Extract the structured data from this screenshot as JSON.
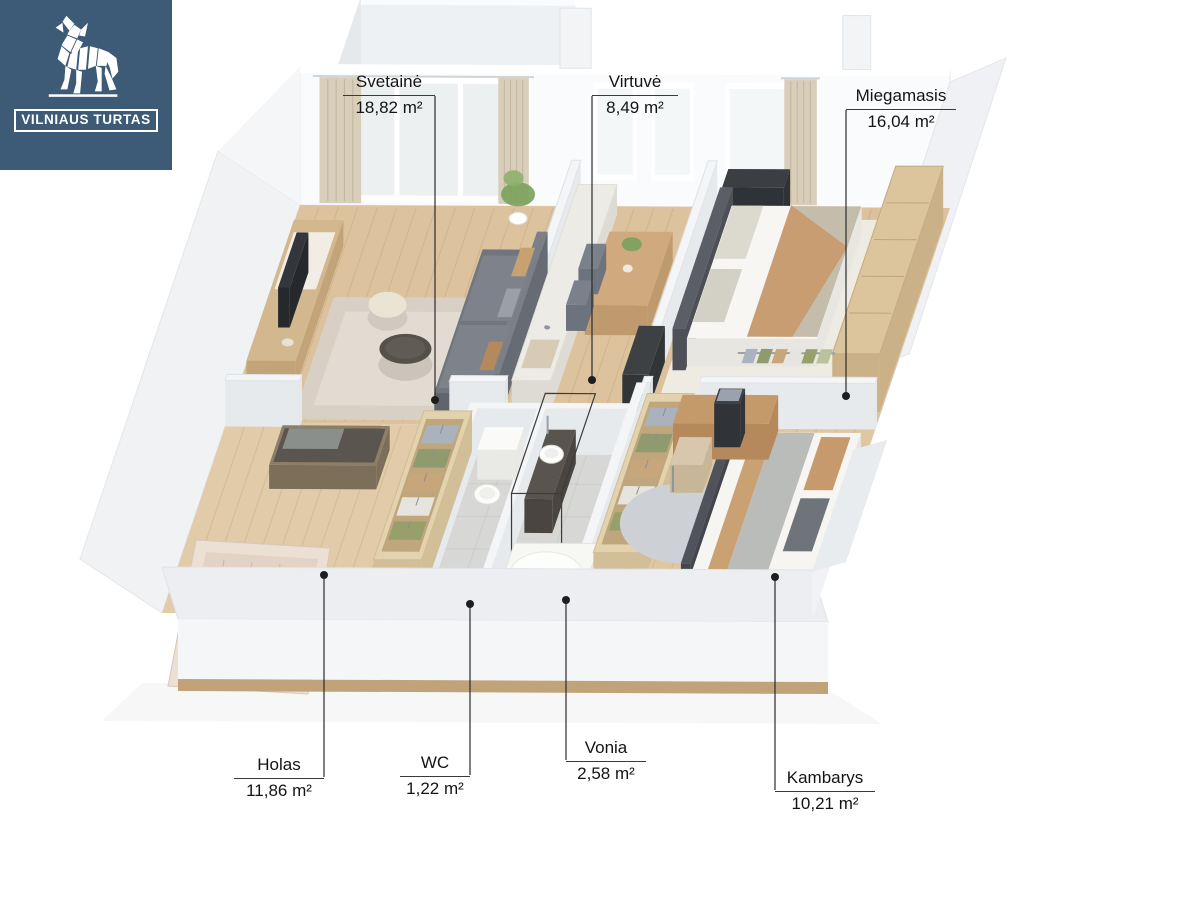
{
  "logo": {
    "company": "VILNIAUS TURTAS"
  },
  "rooms": [
    {
      "id": "svetaine",
      "name": "Svetainė",
      "area": "18,82 m²"
    },
    {
      "id": "virtuve",
      "name": "Virtuvė",
      "area": "8,49 m²"
    },
    {
      "id": "miegamasis",
      "name": "Miegamasis",
      "area": "16,04 m²"
    },
    {
      "id": "holas",
      "name": "Holas",
      "area": "11,86 m²"
    },
    {
      "id": "wc",
      "name": "WC",
      "area": "1,22 m²"
    },
    {
      "id": "vonia",
      "name": "Vonia",
      "area": "2,58 m²"
    },
    {
      "id": "kambarys",
      "name": "Kambarys",
      "area": "10,21 m²"
    }
  ],
  "colors": {
    "brand_blue": "#3d5a76",
    "label_line": "#3a3a3a",
    "wood_floor": "#dcc39e",
    "tile_floor": "#d7d8d6",
    "curtain": "#d9ceba",
    "wall": "#f4f5f7",
    "baseboard": "#c0a379"
  }
}
